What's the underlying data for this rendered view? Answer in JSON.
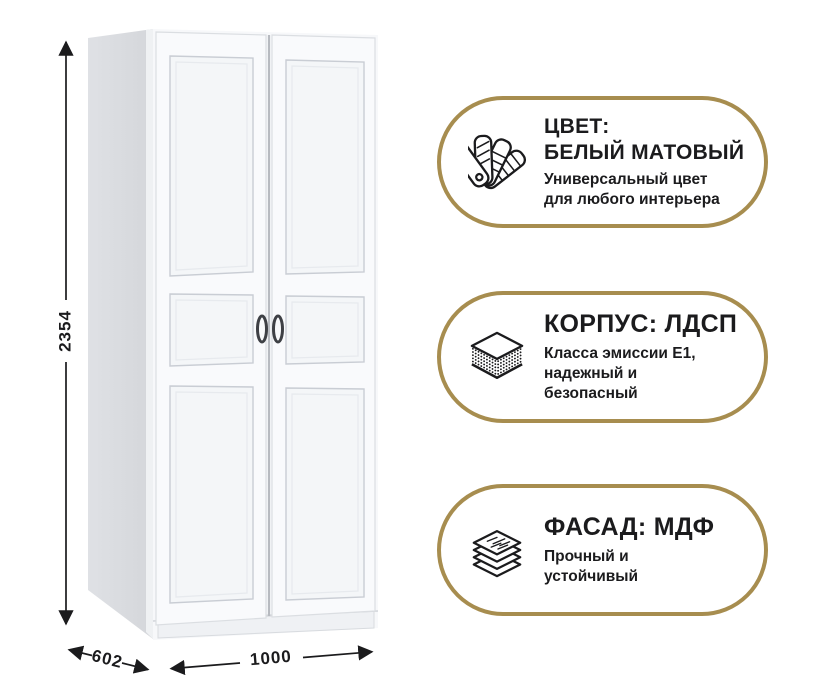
{
  "page": {
    "background": "#ffffff"
  },
  "colors": {
    "accent_gold": "#a78d4f",
    "ink": "#1b1b1d",
    "wardrobe_side": "#d9dbdf",
    "wardrobe_front": "#f7f8fa"
  },
  "dimensions": {
    "height_label": "2354",
    "depth_label": "602",
    "width_label": "1000"
  },
  "badges": [
    {
      "icon": "color-swatch-fan-icon",
      "title_line1": "ЦВЕТ:",
      "title_line2": "БЕЛЫЙ МАТОВЫЙ",
      "subtitle_line1": "Универсальный цвет",
      "subtitle_line2": "для любого интерьера"
    },
    {
      "icon": "chipboard-layers-icon",
      "title_line1": "КОРПУС: ЛДСП",
      "subtitle_line1": "Класса эмиссии Е1,",
      "subtitle_line2": "надежный и",
      "subtitle_line3": "безопасный"
    },
    {
      "icon": "mdf-stacked-sheets-icon",
      "title_line1": "ФАСАД: МДФ",
      "subtitle_line1": "Прочный и",
      "subtitle_line2": "устойчивый"
    }
  ]
}
